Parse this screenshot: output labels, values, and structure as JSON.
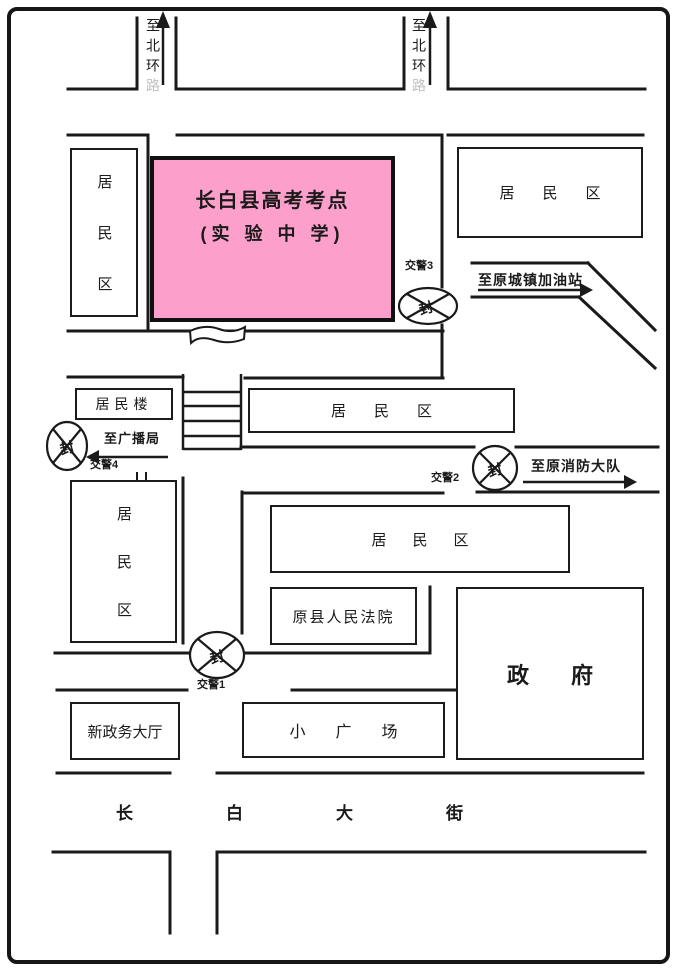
{
  "exam_site": {
    "line1": "长白县高考考点",
    "line2": "(实 验 中 学)",
    "fill_color": "#fc9fcb"
  },
  "areas": {
    "res_left_top": "居民区",
    "res_right_top": "居民区",
    "res_building": "居民楼",
    "res_mid": "居民区",
    "res_lower_left": "居民区",
    "res_lower_mid": "居民区",
    "court": "原县人民法院",
    "government": "政府",
    "new_hall": "新政务大厅",
    "plaza": "小广场"
  },
  "streets": {
    "main": "长白大街"
  },
  "directions": {
    "north_left": {
      "visible": "至北环",
      "faded": "路"
    },
    "north_right": {
      "visible": "至北环",
      "faded": "路"
    },
    "gas_station": "至原城镇加油站",
    "fire_brigade": "至原消防大队",
    "broadcast": "至广播局"
  },
  "checkpoints": [
    {
      "label": "交警1",
      "seal": "封"
    },
    {
      "label": "交警2",
      "seal": "封"
    },
    {
      "label": "交警3",
      "seal": "封"
    },
    {
      "label": "交警4",
      "seal": "封"
    }
  ],
  "colors": {
    "road_line": "#1a1a1a"
  }
}
